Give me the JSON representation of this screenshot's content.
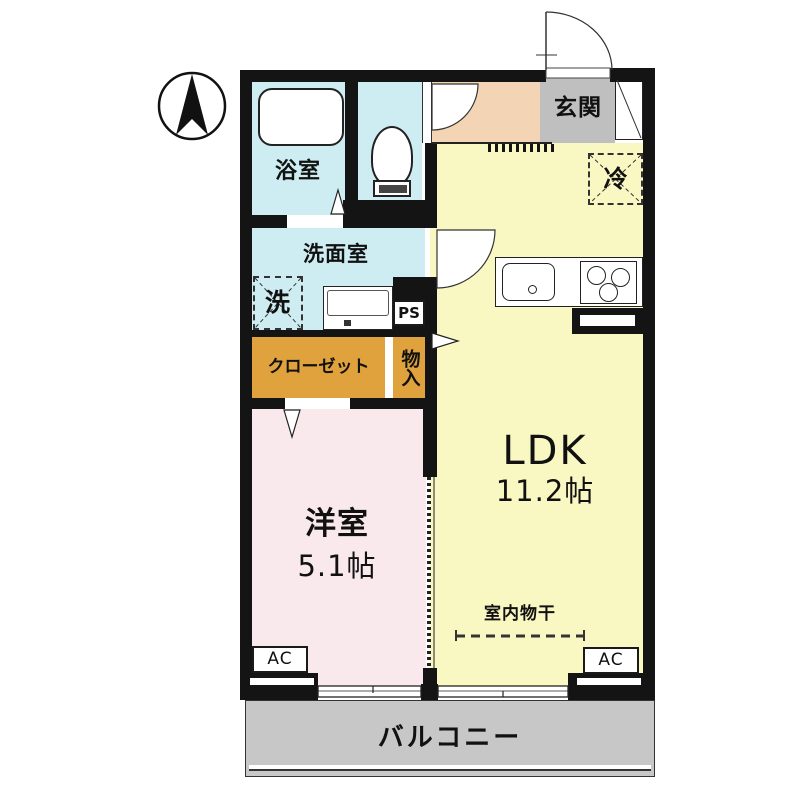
{
  "plan": {
    "bathroom_label": "浴室",
    "washroom_label": "洗面室",
    "washer_label": "洗",
    "closet_label": "クローゼット",
    "storage_label": "物入",
    "ps_label": "PS",
    "entrance_label": "玄関",
    "fridge_label": "冷",
    "ldk_label": "LDK",
    "ldk_size": "11.2帖",
    "western_label": "洋室",
    "western_size": "5.1帖",
    "drying_label": "室内物干",
    "ac_left_label": "AC",
    "ac_right_label": "AC",
    "balcony_label": "バルコニー"
  },
  "colors": {
    "wall": "#141414",
    "water_rooms": "#cdedf2",
    "ldk": "#f9f8c3",
    "western_room": "#f9e9ed",
    "closet": "#dfa23c",
    "hallway": "#f3d5b6",
    "entrance": "#bfbfbf",
    "balcony": "#c7c7c7"
  }
}
